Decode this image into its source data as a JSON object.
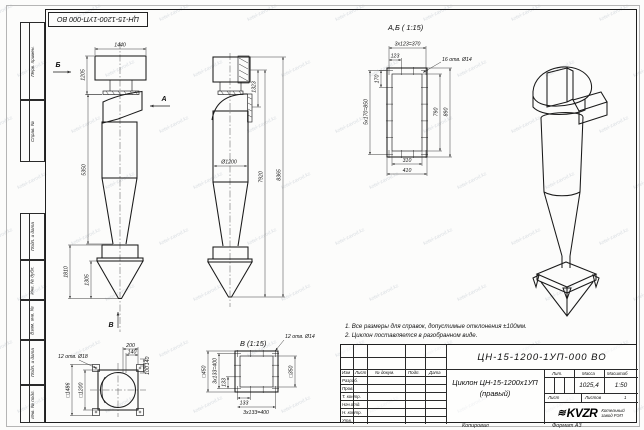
{
  "watermark": {
    "text": "kotel-zavod.kz"
  },
  "frame": {
    "corner_stamp": "ЦН-15-1200-1УП-000 ВО",
    "left_labels": [
      "Перв. примен.",
      "Справ. №",
      "Подп. и дата",
      "Инв. № дубл.",
      "Взам. инв. №",
      "Подп. и дата",
      "Инв. № подл."
    ]
  },
  "views": {
    "side": {
      "dir_b": "Б",
      "dir_a": "А",
      "dir_v": "В",
      "dim_width": "1440",
      "dim_inlet": "1205",
      "dim_body": "5350",
      "dim_hopper": "1810",
      "dim_hopper_inner": "1305"
    },
    "front": {
      "dim_flange": "1323",
      "dim_dia": "Ø1200",
      "dim_h1": "7920",
      "dim_h2": "8365"
    },
    "section_ab": {
      "title": "А,Б ( 1:15)",
      "dim_top": "3x123=370",
      "dim_pitch": "123",
      "holes": "16 отв. Ø14",
      "dim_corner": "170",
      "dim_left": "5x170=850",
      "dim_inner_h": "790",
      "dim_outer_h": "890",
      "dim_inner_w": "310",
      "dim_outer_w": "410"
    },
    "view_v": {
      "title": "В (1:15)",
      "holes": "12 отв. Ø14",
      "dim_outer": "□450",
      "dim_left": "3x133=400",
      "dim_pitch1": "133",
      "dim_pitch2": "133",
      "dim_inner": "□350",
      "dim_bottom": "3x133=400"
    },
    "base": {
      "holes": "12 отв. Ø18",
      "dim_outer": "□1486",
      "dim_inner": "□1200",
      "d1": "200",
      "d2": "140",
      "d3": "140",
      "d4": "100"
    }
  },
  "notes": {
    "line1": "1. Все размеры для справок, допустимые отклонения ±100мм.",
    "line2": "2. Циклон поставляется в разобранном виде."
  },
  "title_block": {
    "doc_number": "ЦН-15-1200-1УП-000 ВО",
    "name_line1": "Циклон ЦН-15-1200х1УП",
    "name_line2": "(правый)",
    "col_izm": "Изм",
    "col_list": "Лист",
    "col_doc": "№ докум.",
    "col_podp": "Подп.",
    "col_data": "Дата",
    "rows": [
      "Разраб.",
      "Пров.",
      "Т. контр.",
      "Нач.отд.",
      "Н. контр.",
      "Утв."
    ],
    "lit": "Лит.",
    "mass": "Масса",
    "scale": "Масштаб",
    "mass_value": "1025,4",
    "scale_value": "1:50",
    "sheet": "Лист",
    "sheets": "Листов",
    "sheets_value": "1",
    "logo": "KVZR",
    "logo_glyph": "≋",
    "company_l1": "Котельный",
    "company_l2": "завод РЭП",
    "footer_copy": "Копировал",
    "footer_format": "Формат А3"
  }
}
